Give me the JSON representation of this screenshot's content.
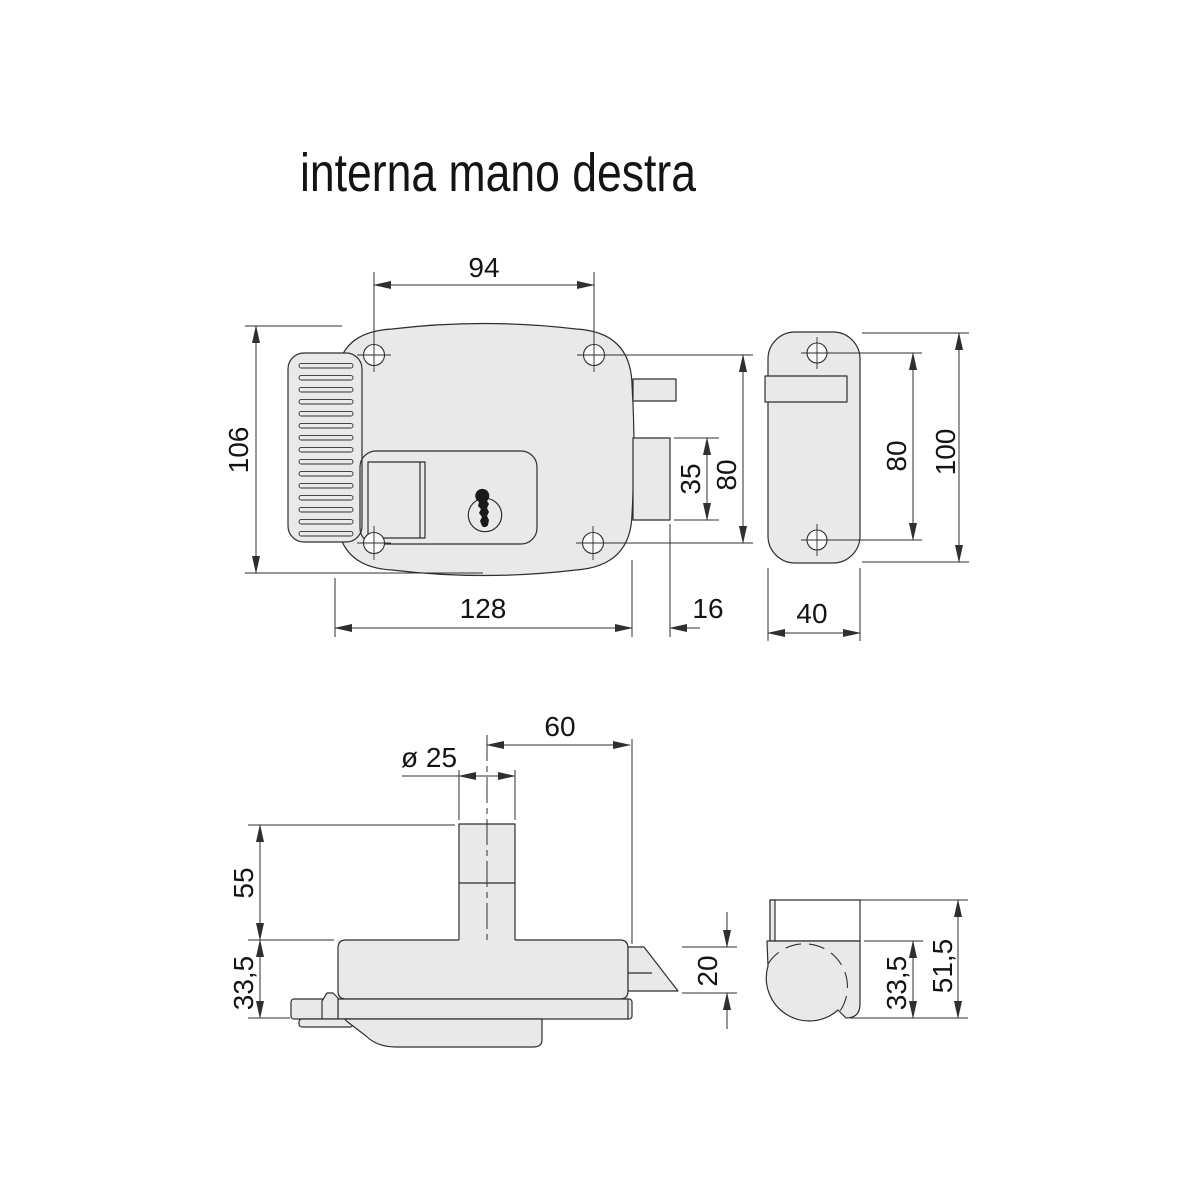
{
  "title": "interna mano destra",
  "colors": {
    "part_fill": "#e9e9e9",
    "line": "#2f2f2f",
    "text": "#141414",
    "background": "#ffffff"
  },
  "views": {
    "front": {
      "label": "front-view-of-lock-body",
      "dims": {
        "hole_spacing_horizontal": "94",
        "body_height": "106",
        "body_width": "128",
        "bolt_extension": "16",
        "bolt_height": "35",
        "hole_spacing_vertical": "80"
      }
    },
    "side": {
      "label": "side-view-strike-plate",
      "dims": {
        "hole_spacing": "80",
        "height": "100",
        "width": "40"
      }
    },
    "bottom": {
      "label": "bottom-view-of-lock",
      "dims": {
        "cylinder_diameter": "ø 25",
        "cylinder_offset": "60",
        "cylinder_length": "55",
        "body_thickness": "33,5",
        "latch_depth": "20"
      }
    },
    "side_bottom": {
      "label": "side-bottom-view",
      "dims": {
        "body_thickness": "33,5",
        "total_depth": "51,5"
      }
    }
  }
}
